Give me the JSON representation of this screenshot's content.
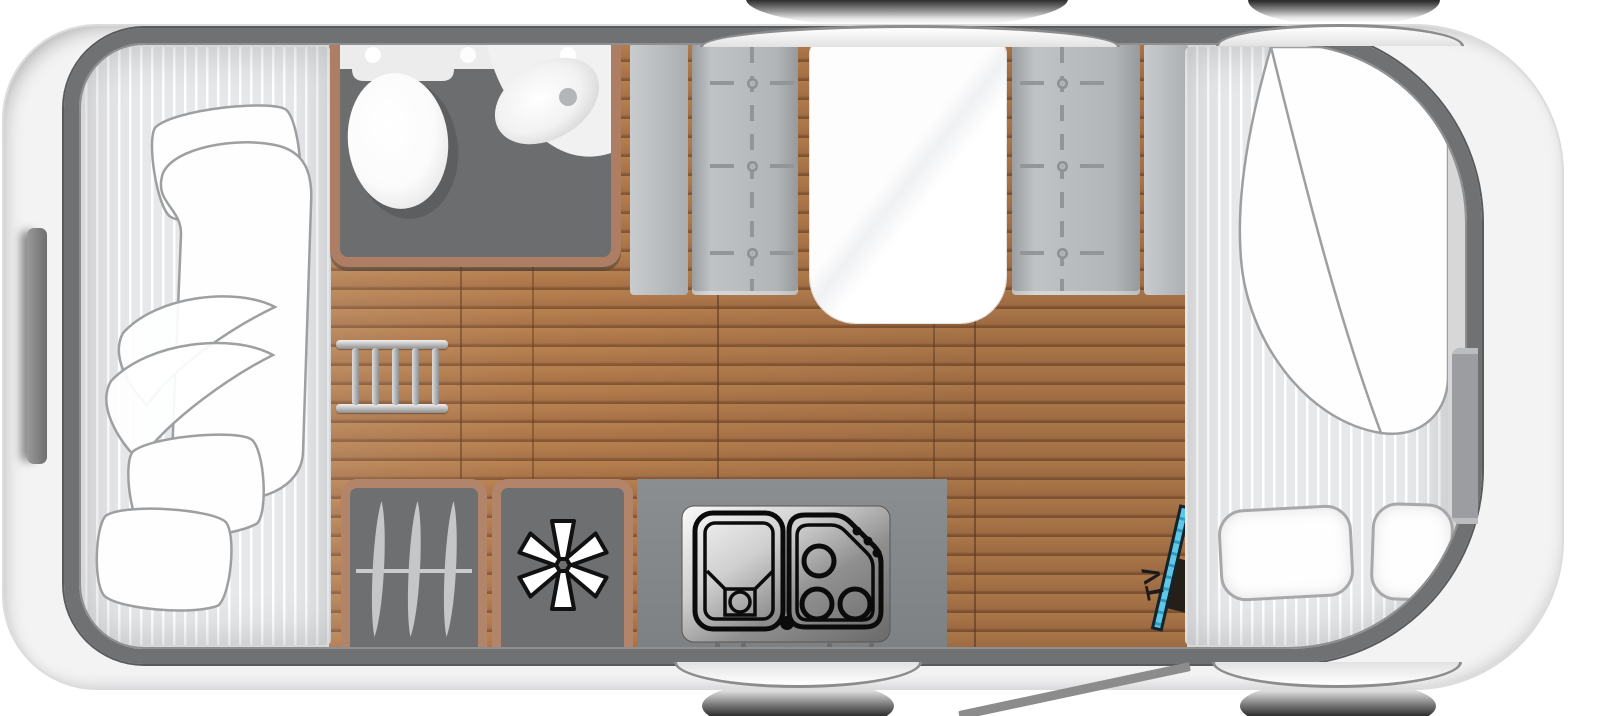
{
  "vehicle": {
    "brand_first_letter": "S",
    "brand_rest": "TYLE",
    "variant": "490 K"
  },
  "labels": {
    "tv": "TV"
  },
  "colors": {
    "body_shell": "#f3f3f4",
    "interior_wall": "#707173",
    "wood_floor": "#b07947",
    "furniture_trim_brown": "#b2856b",
    "bathroom_floor": "#6b6d6f",
    "cabinet_gray": "#6d6f71",
    "bench_gray": "#b2b5b7",
    "mattress_gray": "#e7e8ea",
    "bedding_white": "#fefefe",
    "tv_screen_blue": "#45b6dc",
    "badge_text": "#161616"
  }
}
